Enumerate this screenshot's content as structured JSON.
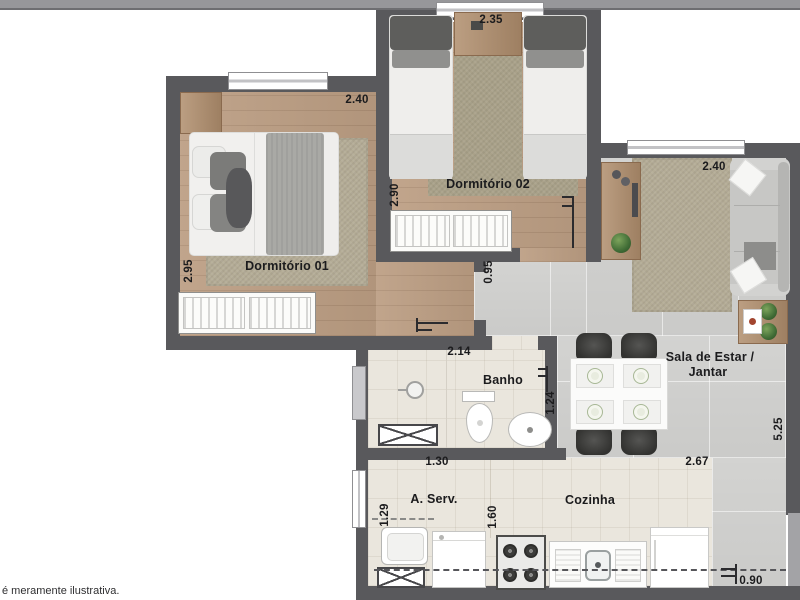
{
  "plan": {
    "disclaimer": "é meramente ilustrativa.",
    "rooms": {
      "dorm01": {
        "label": "Dormitório 01",
        "width": "2.40",
        "depth": "2.95"
      },
      "dorm02": {
        "label": "Dormitório 02",
        "width": "2.35",
        "depth": "2.90"
      },
      "hall": {
        "width": "0.95"
      },
      "sala": {
        "label_line1": "Sala de Estar /",
        "label_line2": "Jantar",
        "width": "2.40",
        "depth": "5.25"
      },
      "banho": {
        "label": "Banho",
        "width": "2.14",
        "depth": "1.24"
      },
      "aserv": {
        "label": "A. Serv.",
        "width": "1.30",
        "depth": "1.29"
      },
      "cozinha": {
        "label": "Cozinha",
        "width": "2.67",
        "depth": "1.60",
        "door_width": "0.90"
      }
    },
    "colors": {
      "wall": "#59595c",
      "wood_floor": "#bc9e83",
      "tile_gray": "#d7d7d5",
      "tile_beige": "#eae6dd",
      "rug": "#b4ac96",
      "label_text": "#1b1b1d"
    }
  }
}
